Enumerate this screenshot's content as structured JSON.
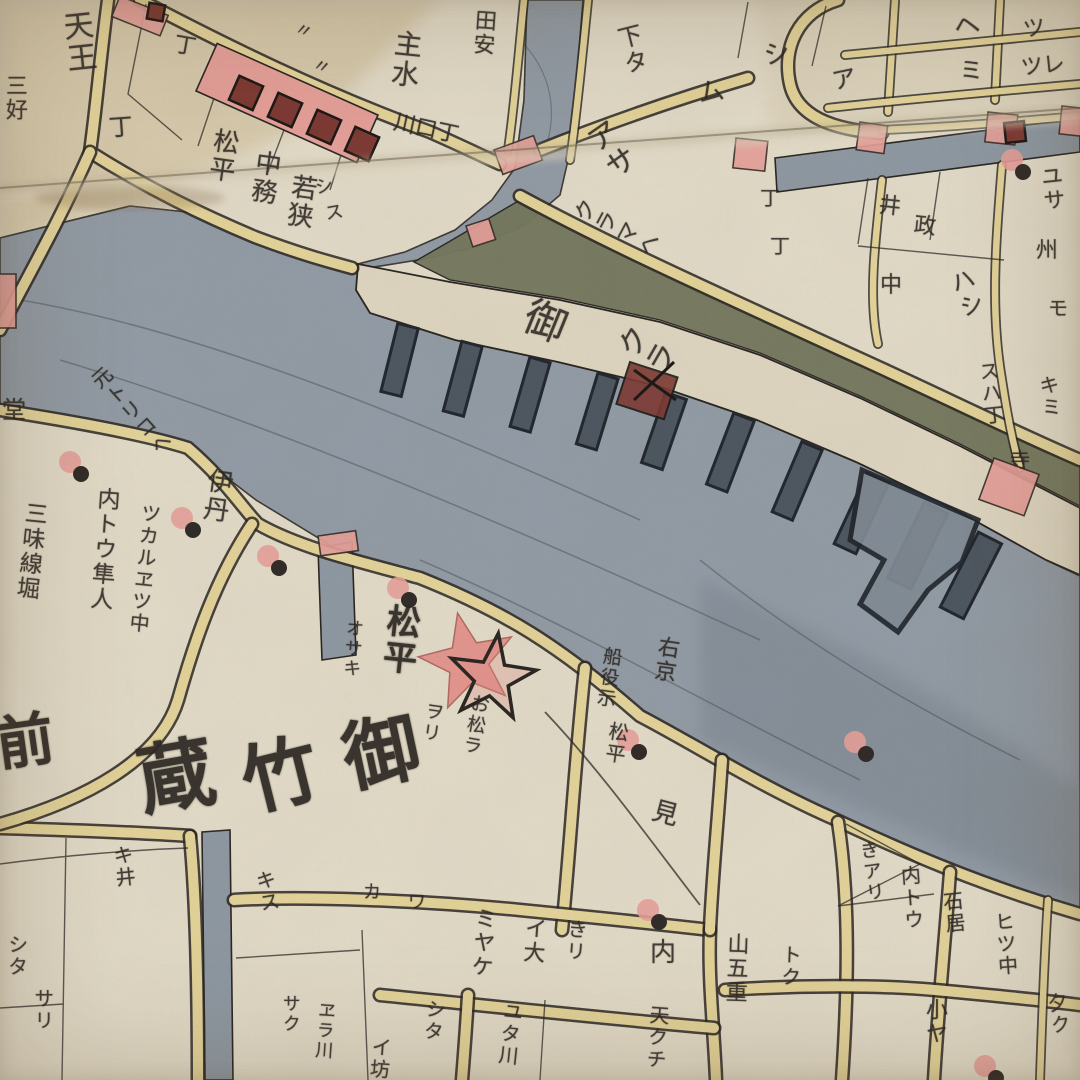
{
  "map": {
    "kind": "edo-woodblock-kiriezu-map",
    "river_area_label": "御竹蔵",
    "granary_label": "御クラ"
  },
  "palette": {
    "paper": "#e0d9c7",
    "block_cream": "#e7e1d0",
    "road_yellow": "#e3d49b",
    "water_gray": "#939ca6",
    "water_dark": "#4e5862",
    "storehouse_olive": "#75795f",
    "pink": "#e5a09a",
    "salmon_star": "#e2938c",
    "dark_red": "#7e3a34",
    "ink": "#2d2823"
  },
  "labels": [
    {
      "t": "天王",
      "x": 58,
      "y": 12,
      "s": 30,
      "v": 1,
      "r": -6
    },
    {
      "t": "丁",
      "x": 108,
      "y": 116,
      "s": 24,
      "r": -4
    },
    {
      "t": "三好",
      "x": 2,
      "y": 74,
      "s": 22,
      "v": 1,
      "r": 0
    },
    {
      "t": "丁",
      "x": 176,
      "y": 34,
      "s": 22,
      "r": 10
    },
    {
      "t": "〃",
      "x": 298,
      "y": 20,
      "s": 18,
      "r": 20
    },
    {
      "t": "〃",
      "x": 316,
      "y": 56,
      "s": 18,
      "r": 20
    },
    {
      "t": "松平",
      "x": 212,
      "y": 126,
      "s": 26,
      "v": 1,
      "r": 8
    },
    {
      "t": "中務",
      "x": 254,
      "y": 148,
      "s": 26,
      "v": 1,
      "r": 8
    },
    {
      "t": "若狭",
      "x": 290,
      "y": 172,
      "s": 26,
      "v": 1,
      "r": 8
    },
    {
      "t": "主水",
      "x": 394,
      "y": 28,
      "s": 28,
      "v": 1,
      "r": 6
    },
    {
      "t": "田安",
      "x": 472,
      "y": 8,
      "s": 22,
      "v": 1,
      "r": 4
    },
    {
      "t": "川口丁",
      "x": 396,
      "y": 112,
      "s": 22,
      "r": 12
    },
    {
      "t": "下タ",
      "x": 612,
      "y": 28,
      "s": 24,
      "v": 1,
      "r": -14
    },
    {
      "t": "ム",
      "x": 696,
      "y": 82,
      "s": 26,
      "r": -10
    },
    {
      "t": "シ",
      "x": 762,
      "y": 44,
      "s": 26,
      "r": -10
    },
    {
      "t": "ヘ",
      "x": 952,
      "y": 16,
      "s": 26,
      "r": -10
    },
    {
      "t": "ツ",
      "x": 1022,
      "y": 20,
      "s": 22,
      "r": -8
    },
    {
      "t": "ミ",
      "x": 958,
      "y": 60,
      "s": 24,
      "r": -6
    },
    {
      "t": "ツレ",
      "x": 1020,
      "y": 58,
      "s": 22,
      "r": -6
    },
    {
      "t": "ア",
      "x": 830,
      "y": 70,
      "s": 24,
      "r": -12
    },
    {
      "t": "ユサ",
      "x": 1036,
      "y": 166,
      "s": 22,
      "v": 1,
      "r": -6
    },
    {
      "t": "アサ",
      "x": 578,
      "y": 134,
      "s": 30,
      "v": 1,
      "r": -35
    },
    {
      "t": "丁",
      "x": 760,
      "y": 188,
      "s": 20,
      "r": 0
    },
    {
      "t": "丁",
      "x": 770,
      "y": 236,
      "s": 20,
      "r": 0
    },
    {
      "t": "井",
      "x": 880,
      "y": 195,
      "s": 22,
      "r": 6
    },
    {
      "t": "政",
      "x": 915,
      "y": 215,
      "s": 22,
      "r": 6
    },
    {
      "t": "中",
      "x": 880,
      "y": 275,
      "s": 22,
      "r": 0
    },
    {
      "t": "ハシ",
      "x": 944,
      "y": 274,
      "s": 24,
      "v": 1,
      "r": -20
    },
    {
      "t": "州",
      "x": 1032,
      "y": 238,
      "s": 22,
      "v": 1,
      "r": 0
    },
    {
      "t": "モ",
      "x": 1048,
      "y": 298,
      "s": 20,
      "r": 0
    },
    {
      "t": "シ",
      "x": 314,
      "y": 180,
      "s": 18,
      "r": -10
    },
    {
      "t": "ス",
      "x": 324,
      "y": 206,
      "s": 18,
      "r": -10
    },
    {
      "t": "堂",
      "x": 2,
      "y": 398,
      "s": 24,
      "r": 0
    },
    {
      "t": "元トリコヘ",
      "x": 86,
      "y": 378,
      "s": 20,
      "v": 1,
      "r": -42
    },
    {
      "t": "内トウ隼人",
      "x": 94,
      "y": 486,
      "s": 23,
      "v": 1,
      "r": 4
    },
    {
      "t": "ツカルヱツ中",
      "x": 140,
      "y": 502,
      "s": 20,
      "v": 1,
      "r": 6
    },
    {
      "t": "伊丹",
      "x": 206,
      "y": 466,
      "s": 26,
      "v": 1,
      "r": 8
    },
    {
      "t": "三味線堀",
      "x": 22,
      "y": 500,
      "s": 23,
      "v": 1,
      "r": 6
    },
    {
      "t": "クラマヘ",
      "x": 568,
      "y": 218,
      "s": 22,
      "v": 1,
      "r": -62
    },
    {
      "t": "御",
      "x": 534,
      "y": 294,
      "s": 42,
      "r": 22
    },
    {
      "t": "クラ",
      "x": 610,
      "y": 350,
      "s": 30,
      "v": 1,
      "r": -60
    },
    {
      "t": "スハ丁",
      "x": 976,
      "y": 362,
      "s": 20,
      "v": 1,
      "r": -6
    },
    {
      "t": "キミ",
      "x": 1036,
      "y": 376,
      "s": 20,
      "v": 1,
      "r": -6
    },
    {
      "t": "寺",
      "x": 1010,
      "y": 450,
      "s": 20,
      "r": 0
    },
    {
      "t": "松平",
      "x": 384,
      "y": 602,
      "s": 34,
      "v": 1,
      "r": 6,
      "b": 1
    },
    {
      "t": "オサキ",
      "x": 344,
      "y": 618,
      "s": 18,
      "v": 1,
      "r": 4
    },
    {
      "t": "ヲリ",
      "x": 424,
      "y": 700,
      "s": 19,
      "v": 1,
      "r": 8
    },
    {
      "t": "お松ラ",
      "x": 470,
      "y": 692,
      "s": 19,
      "v": 1,
      "r": 10
    },
    {
      "t": "船役示",
      "x": 602,
      "y": 645,
      "s": 19,
      "v": 1,
      "r": 8
    },
    {
      "t": "右京",
      "x": 656,
      "y": 634,
      "s": 22,
      "v": 1,
      "r": 8
    },
    {
      "t": "松平",
      "x": 608,
      "y": 720,
      "s": 20,
      "v": 1,
      "r": 8
    },
    {
      "t": "前",
      "x": -8,
      "y": 716,
      "s": 58,
      "r": -8,
      "b": 1
    },
    {
      "t": "蔵",
      "x": 132,
      "y": 744,
      "s": 76,
      "r": -10,
      "b": 1
    },
    {
      "t": "竹",
      "x": 234,
      "y": 746,
      "s": 76,
      "r": -14,
      "b": 1
    },
    {
      "t": "御",
      "x": 336,
      "y": 722,
      "s": 76,
      "r": -12,
      "b": 1
    },
    {
      "t": "見",
      "x": 656,
      "y": 798,
      "s": 26,
      "r": 15
    },
    {
      "t": "カ",
      "x": 363,
      "y": 884,
      "s": 18,
      "r": 0
    },
    {
      "t": "ワ",
      "x": 408,
      "y": 894,
      "s": 18,
      "r": 0
    },
    {
      "t": "ミヤケ",
      "x": 472,
      "y": 906,
      "s": 22,
      "v": 1,
      "r": 4
    },
    {
      "t": "イ大",
      "x": 522,
      "y": 916,
      "s": 22,
      "v": 1,
      "r": 4
    },
    {
      "t": "きリ",
      "x": 566,
      "y": 918,
      "s": 20,
      "v": 1,
      "r": 4
    },
    {
      "t": "内",
      "x": 650,
      "y": 940,
      "s": 26,
      "r": 0
    },
    {
      "t": "シタ",
      "x": 424,
      "y": 998,
      "s": 20,
      "v": 1,
      "r": 4
    },
    {
      "t": "イ坊",
      "x": 370,
      "y": 1036,
      "s": 20,
      "v": 1,
      "r": 4
    },
    {
      "t": "ユタ川",
      "x": 502,
      "y": 1000,
      "s": 20,
      "v": 1,
      "r": 6
    },
    {
      "t": "天クチ",
      "x": 648,
      "y": 1004,
      "s": 20,
      "v": 1,
      "r": 4
    },
    {
      "t": "サク",
      "x": 280,
      "y": 994,
      "s": 18,
      "v": 1,
      "r": 0
    },
    {
      "t": "ヱラ川",
      "x": 316,
      "y": 1000,
      "s": 18,
      "v": 1,
      "r": 4
    },
    {
      "t": "キス",
      "x": 252,
      "y": 872,
      "s": 20,
      "v": 1,
      "r": -10
    },
    {
      "t": "キ井",
      "x": 110,
      "y": 846,
      "s": 20,
      "v": 1,
      "r": -6
    },
    {
      "t": "シタ",
      "x": 6,
      "y": 934,
      "s": 20,
      "v": 1,
      "r": 0
    },
    {
      "t": "サリ",
      "x": 32,
      "y": 988,
      "s": 20,
      "v": 1,
      "r": 0
    },
    {
      "t": "きアリ",
      "x": 856,
      "y": 842,
      "s": 19,
      "v": 1,
      "r": -8
    },
    {
      "t": "内トウ",
      "x": 898,
      "y": 866,
      "s": 20,
      "v": 1,
      "r": -4
    },
    {
      "t": "石居",
      "x": 940,
      "y": 892,
      "s": 20,
      "v": 1,
      "r": -6
    },
    {
      "t": "ヒツ中",
      "x": 992,
      "y": 912,
      "s": 20,
      "v": 1,
      "r": -4
    },
    {
      "t": "小ヤ",
      "x": 922,
      "y": 998,
      "s": 22,
      "v": 1,
      "r": 0
    },
    {
      "t": "山五重",
      "x": 724,
      "y": 932,
      "s": 22,
      "v": 1,
      "r": 2
    },
    {
      "t": "トク",
      "x": 780,
      "y": 944,
      "s": 20,
      "v": 1,
      "r": 2
    },
    {
      "t": "夕ク",
      "x": 1044,
      "y": 994,
      "s": 20,
      "v": 1,
      "r": -8
    }
  ],
  "markers": [
    {
      "x": 70,
      "y": 462
    },
    {
      "x": 182,
      "y": 518
    },
    {
      "x": 268,
      "y": 556
    },
    {
      "x": 398,
      "y": 588
    },
    {
      "x": 628,
      "y": 740
    },
    {
      "x": 855,
      "y": 742
    },
    {
      "x": 648,
      "y": 910
    },
    {
      "x": 985,
      "y": 1066
    },
    {
      "x": 1012,
      "y": 160
    }
  ],
  "piers": [
    {
      "x": 408,
      "y": 326,
      "r": 14,
      "w": 21,
      "h": 70
    },
    {
      "x": 472,
      "y": 344,
      "r": 15,
      "w": 21,
      "h": 72
    },
    {
      "x": 540,
      "y": 360,
      "r": 16,
      "w": 21,
      "h": 72
    },
    {
      "x": 608,
      "y": 376,
      "r": 17,
      "w": 21,
      "h": 74
    },
    {
      "x": 676,
      "y": 396,
      "r": 19,
      "w": 22,
      "h": 74
    },
    {
      "x": 744,
      "y": 417,
      "r": 21,
      "w": 22,
      "h": 76
    },
    {
      "x": 812,
      "y": 446,
      "r": 23,
      "w": 22,
      "h": 76
    },
    {
      "x": 878,
      "y": 478,
      "r": 25,
      "w": 24,
      "h": 78
    },
    {
      "x": 936,
      "y": 508,
      "r": 26,
      "w": 26,
      "h": 84
    },
    {
      "x": 990,
      "y": 538,
      "r": 27,
      "w": 26,
      "h": 84
    }
  ],
  "pink_blocks": [
    {
      "x": 494,
      "y": 150,
      "w": 42,
      "h": 26,
      "r": -20
    },
    {
      "x": 860,
      "y": 122,
      "w": 28,
      "h": 28,
      "r": 8
    },
    {
      "x": 988,
      "y": 112,
      "w": 30,
      "h": 30,
      "r": 6
    },
    {
      "x": 1062,
      "y": 106,
      "w": 22,
      "h": 28,
      "r": 6
    },
    {
      "x": 736,
      "y": 138,
      "w": 32,
      "h": 30,
      "r": 6
    },
    {
      "x": 994,
      "y": 458,
      "w": 48,
      "h": 44,
      "r": 20
    },
    {
      "x": 120,
      "y": -4,
      "w": 52,
      "h": 22,
      "r": 22
    },
    {
      "x": -4,
      "y": 274,
      "w": 20,
      "h": 54,
      "r": 0
    },
    {
      "x": 318,
      "y": 536,
      "w": 38,
      "h": 20,
      "r": -8
    },
    {
      "x": 466,
      "y": 226,
      "w": 24,
      "h": 22,
      "r": -18
    }
  ],
  "storehouse_squares": [
    {
      "x": 233,
      "y": 80,
      "s": 26,
      "r": 24
    },
    {
      "x": 272,
      "y": 97,
      "s": 26,
      "r": 24
    },
    {
      "x": 311,
      "y": 114,
      "s": 26,
      "r": 24
    },
    {
      "x": 349,
      "y": 131,
      "s": 26,
      "r": 24
    },
    {
      "x": 148,
      "y": 4,
      "s": 16,
      "r": 10
    },
    {
      "x": 1005,
      "y": 122,
      "s": 20,
      "r": -6
    }
  ],
  "star": {
    "back": {
      "cx": 468,
      "cy": 662,
      "R": 50,
      "r": 21,
      "rot": -12
    },
    "front": {
      "cx": 492,
      "cy": 678,
      "R": 45,
      "r": 18,
      "rot": 8
    }
  },
  "watergate": {
    "x": 630,
    "y": 362,
    "w": 50,
    "h": 44,
    "r": 18
  }
}
